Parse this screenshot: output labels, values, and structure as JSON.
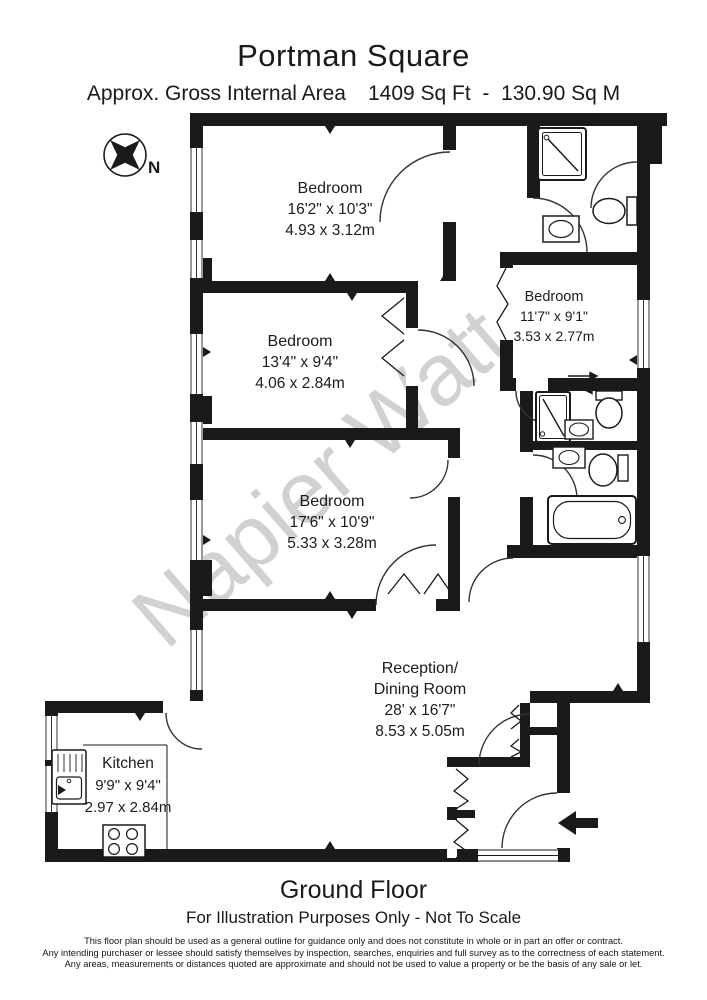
{
  "header": {
    "title": "Portman Square",
    "area_label": "Approx. Gross Internal Area",
    "area_value": "1409 Sq Ft  -  130.90 Sq M"
  },
  "compass": {
    "label": "N"
  },
  "watermark": "Napier Watt",
  "rooms": [
    {
      "id": "bedroom-1",
      "name": "Bedroom",
      "imperial": "16'2\" x 10'3\"",
      "metric": "4.93 x 3.12m"
    },
    {
      "id": "bedroom-2",
      "name": "Bedroom",
      "imperial": "13'4\" x 9'4\"",
      "metric": "4.06 x 2.84m"
    },
    {
      "id": "bedroom-3",
      "name": "Bedroom",
      "imperial": "11'7\" x 9'1\"",
      "metric": "3.53 x 2.77m"
    },
    {
      "id": "bedroom-4",
      "name": "Bedroom",
      "imperial": "17'6\" x 10'9\"",
      "metric": "5.33 x 3.28m"
    },
    {
      "id": "reception",
      "name": "Reception/",
      "name_line2": "Dining Room",
      "imperial": "28' x 16'7\"",
      "metric": "8.53 x 5.05m"
    },
    {
      "id": "kitchen",
      "name": "Kitchen",
      "imperial": "9'9\" x 9'4\"",
      "metric": "2.97 x 2.84m"
    }
  ],
  "icons": [
    "compass-icon",
    "entrance-arrow-icon",
    "shower-icon",
    "toilet-icon",
    "basin-icon",
    "bathtub-icon",
    "sink-icon",
    "hob-icon"
  ],
  "footer": {
    "floor": "Ground Floor",
    "note": "For Illustration Purposes Only - Not To Scale",
    "disclaimer": [
      "This floor plan should be used as a general outline for guidance only and does not constitute in whole or in part an offer or contract.",
      "Any intending purchaser or lessee should satisfy themselves by inspection, searches, enquiries and full survey as to the correctness of each statement.",
      "Any areas, measurements or distances quoted are approximate and should not be used to value a property or be the basis of any sale or let."
    ]
  },
  "colors": {
    "wall": "#1a1a1a",
    "line": "#333333",
    "watermark": "#c6c6c6",
    "text": "#1c1c1c"
  }
}
